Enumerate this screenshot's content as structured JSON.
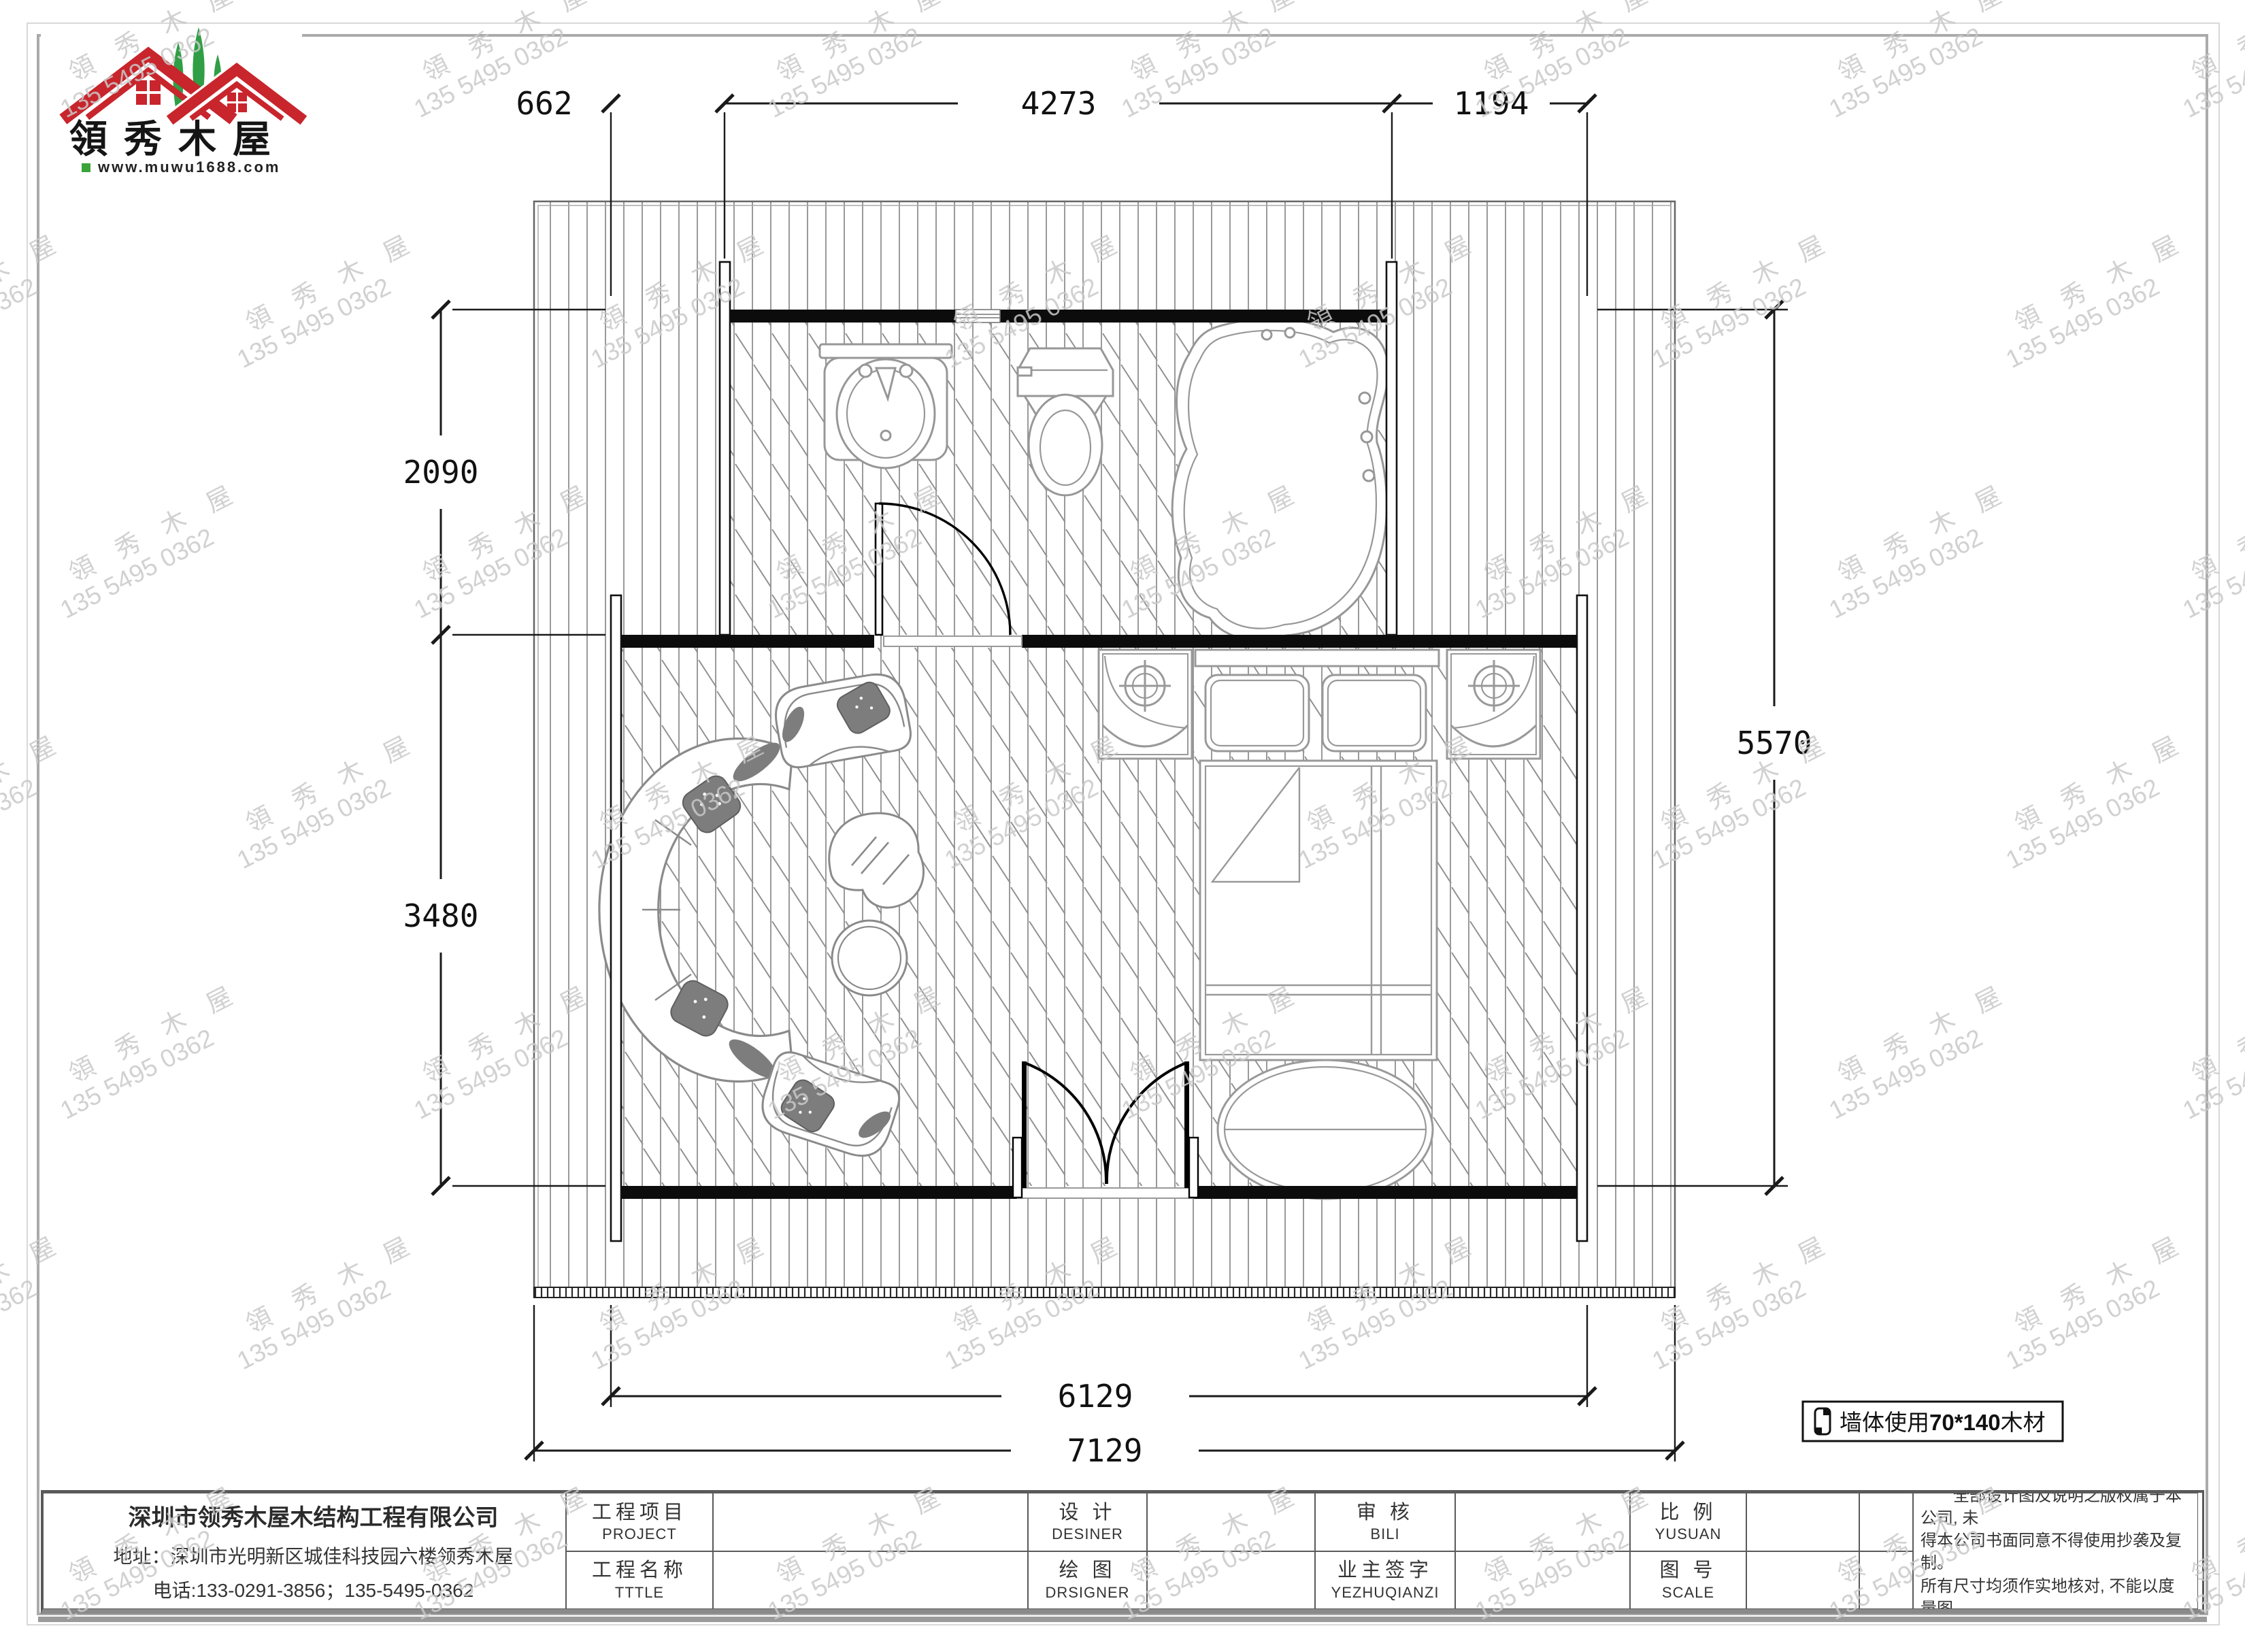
{
  "logo": {
    "brand": "領秀木屋",
    "url": "www.muwu1688.com"
  },
  "watermark": {
    "brand": "領 秀 木 屋",
    "phone": "135 5495 0362"
  },
  "dims": {
    "top": [
      "662",
      "4273",
      "1194"
    ],
    "left": [
      "2090",
      "3480"
    ],
    "right": "5570",
    "bottom": [
      "6129",
      "7129"
    ]
  },
  "wall_note": {
    "prefix": "墙体使用",
    "size": "70*140",
    "suffix": "木材"
  },
  "title_block": {
    "project_cn": "工程项目",
    "project_en": "PROJECT",
    "name_cn": "工程名称",
    "name_en": "TTTLE",
    "design_cn": "设 计",
    "design_en": "DESINER",
    "draw_cn": "绘 图",
    "draw_en": "DRSIGNER",
    "review_cn": "审 核",
    "review_en": "BILI",
    "owner_cn": "业主签字",
    "owner_en": "YEZHUQIANZI",
    "scale_cn": "比 例",
    "scale_en": "YUSUAN",
    "number_cn": "图 号",
    "number_en": "SCALE"
  },
  "company": {
    "name": "深圳市领秀木屋木结构工程有限公司",
    "address": "地址：深圳市光明新区城佳科技园六楼领秀木屋",
    "phone": "电话:133-0291-3856；135-5495-0362"
  },
  "notes": {
    "title": "备注:",
    "lines": [
      "全部设计图及说明之版权属于本公司, 未",
      "得本公司书面同意不得使用抄袭及复制。",
      "所有尺寸均须作实地核对, 不能以度量图",
      "中之中尺寸为准。"
    ]
  }
}
